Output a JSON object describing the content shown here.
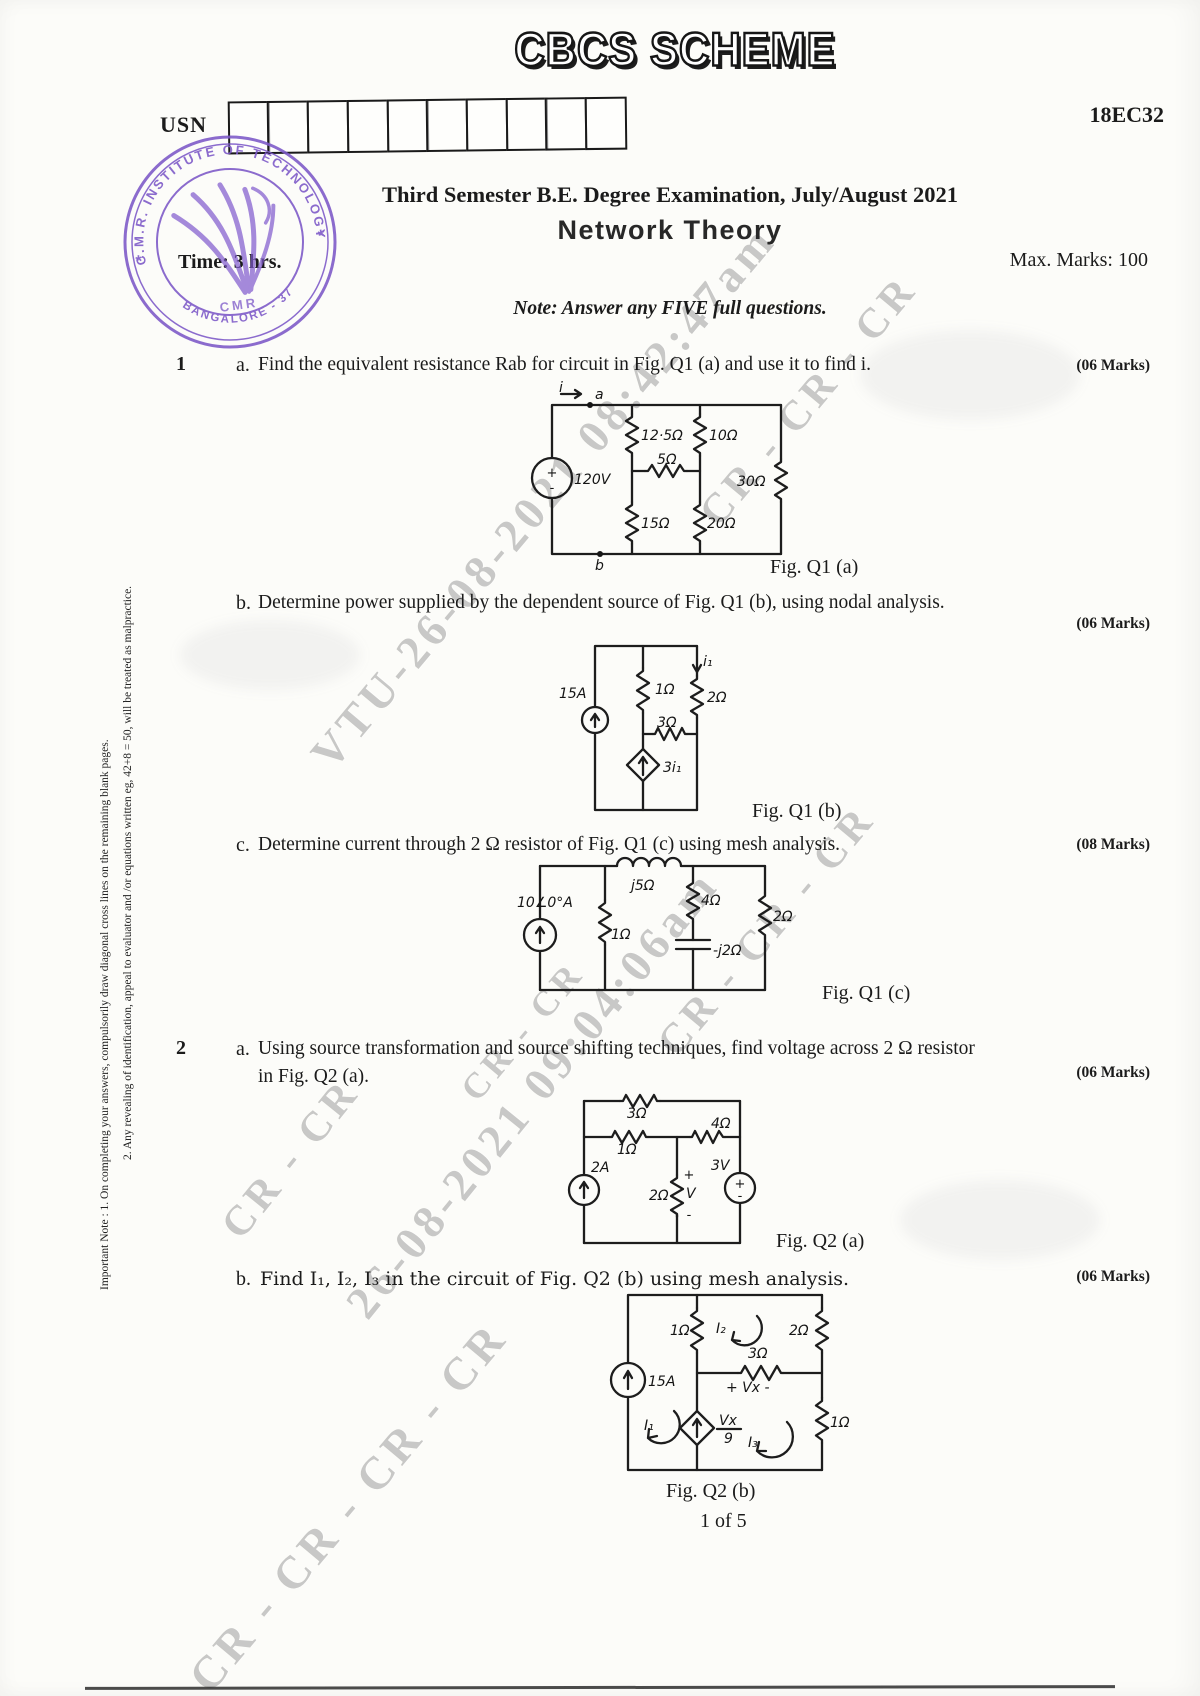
{
  "banner": "CBCS SCHEME",
  "header": {
    "usn_label": "USN",
    "course_code": "18EC32",
    "title": "Third Semester B.E. Degree Examination, July/August 2021",
    "subject": "Network Theory",
    "time": "Time: 3 hrs.",
    "max_marks": "Max. Marks: 100",
    "note": "Note: Answer any FIVE full questions."
  },
  "stamp": {
    "arc": "C.M.R. INSTITUTE OF TECHNOLOGY",
    "bottom": "BANGALORE - 37",
    "center": "CMR",
    "star_left": "*",
    "star_right": "*"
  },
  "margin_note": {
    "line1": "Important Note : 1. On completing your answers, compulsorily draw diagonal cross lines on the remaining blank pages.",
    "line2": "2. Any revealing of identification, appeal to evaluator and /or equations written eg, 42+8 = 50, will be treated as malpractice."
  },
  "watermarks": {
    "vtu": "VTU-26-08-2021 08:42:47am",
    "ts": "26-08-2021 09:04:06am",
    "cr_a": "CR - CR - CR",
    "cr_b": "CR - CR - CR",
    "cr_c": "CR - CR",
    "cr_d": "CR - CR - CR - CR",
    "cr_e": "CR - CR"
  },
  "q1": {
    "number": "1",
    "a": {
      "letter": "a.",
      "text": "Find the equivalent resistance Rab for circuit in Fig. Q1 (a) and use it to find i.",
      "marks": "(06 Marks)"
    },
    "b": {
      "letter": "b.",
      "text": "Determine power supplied by the dependent source of Fig. Q1 (b), using nodal analysis.",
      "marks": "(06 Marks)"
    },
    "c": {
      "letter": "c.",
      "text": "Determine current through 2 Ω resistor of Fig. Q1 (c) using mesh analysis.",
      "marks": "(08 Marks)"
    }
  },
  "q2": {
    "number": "2",
    "a": {
      "letter": "a.",
      "line1": "Using source transformation and source shifting techniques, find voltage across 2 Ω resistor",
      "line2": "in Fig. Q2 (a).",
      "marks": "(06 Marks)"
    },
    "b": {
      "letter": "b.",
      "text": "Find I₁, I₂, I₃ in the circuit of Fig. Q2 (b) using mesh analysis.",
      "marks": "(06 Marks)"
    }
  },
  "figs": {
    "q1a": {
      "caption": "Fig. Q1 (a)",
      "i": "i",
      "a": "a",
      "b": "b",
      "v": "120V",
      "r1": "12·5Ω",
      "r2": "10Ω",
      "r3": "5Ω",
      "r4": "30Ω",
      "r5": "15Ω",
      "r6": "20Ω",
      "plus": "+",
      "minus": "-"
    },
    "q1b": {
      "caption": "Fig. Q1 (b)",
      "src": "15A",
      "r1": "1Ω",
      "r2": "2Ω",
      "r3": "3Ω",
      "dep": "3i₁",
      "i1": "i₁"
    },
    "q1c": {
      "caption": "Fig. Q1 (c)",
      "src": "10∠0°A",
      "l": "j5Ω",
      "r1": "1Ω",
      "r2": "4Ω",
      "c": "-j2Ω",
      "r3": "2Ω"
    },
    "q2a": {
      "caption": "Fig. Q2 (a)",
      "r1": "3Ω",
      "r2": "1Ω",
      "r3": "4Ω",
      "src1": "2A",
      "r4": "2Ω",
      "plus": "+",
      "v": "V",
      "minus": "-",
      "src2": "3V",
      "p2": "+",
      "m2": "-"
    },
    "q2b": {
      "caption": "Fig. Q2 (b)",
      "src": "15A",
      "r1": "1Ω",
      "r2": "2Ω",
      "r3": "3Ω",
      "r4": "1Ω",
      "num": "Vx",
      "den": "9",
      "i1": "I₁",
      "i2": "I₂",
      "i3": "I₃",
      "vmark": "+ Vx -"
    }
  },
  "footer": "1 of 5"
}
